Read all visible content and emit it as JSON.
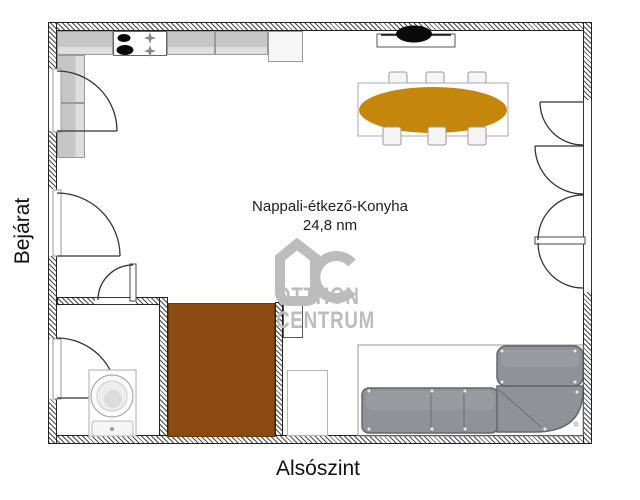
{
  "labels": {
    "room_name": "Nappali-étkező-Konyha",
    "room_area": "24,8 nm",
    "entrance": "Bejárat",
    "floor": "Alsószint"
  },
  "watermark": {
    "line1": "OTTHON",
    "line2": "CENTRUM"
  },
  "colors": {
    "stairs": "#8a4a10",
    "table": "#c5860c",
    "sofa": "#8f9398",
    "sofa_edge": "#63666a",
    "watermark": "#bcbcbc"
  },
  "furniture_legend": {
    "kitchen": "counter with stove and fridge",
    "dining": "oval table with six chairs",
    "living": "corner sofa and TV",
    "utility": "washing machine room",
    "stairs": "stairs block"
  }
}
